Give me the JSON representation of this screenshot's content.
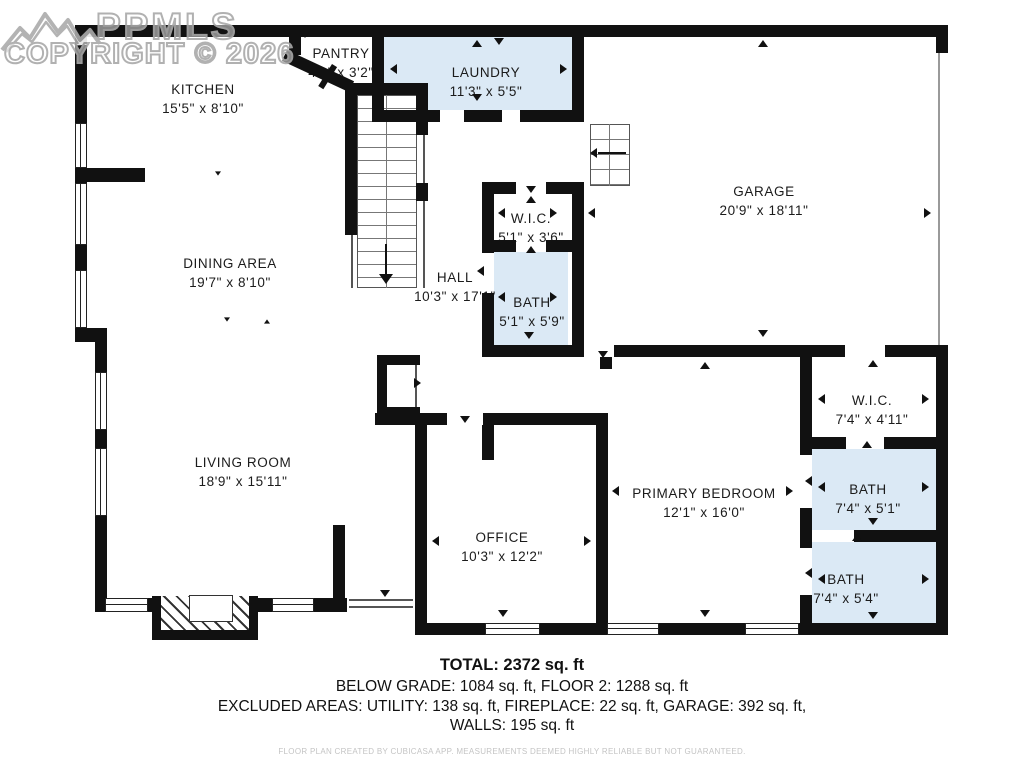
{
  "watermark": {
    "brand": "PPMLS",
    "copyright": "COPYRIGHT © 2026"
  },
  "rooms": {
    "kitchen": {
      "name": "KITCHEN",
      "dims": "15'5\" x 8'10\""
    },
    "pantry": {
      "name": "PANTRY",
      "dims": "4'8\" x 3'2\""
    },
    "laundry": {
      "name": "LAUNDRY",
      "dims": "11'3\" x 5'5\""
    },
    "garage": {
      "name": "GARAGE",
      "dims": "20'9\" x 18'11\""
    },
    "wic_main": {
      "name": "W.I.C.",
      "dims": "5'1\" x 3'6\""
    },
    "hall": {
      "name": "HALL",
      "dims": "10'3\" x 17'1\""
    },
    "bath_main": {
      "name": "BATH",
      "dims": "5'1\" x 5'9\""
    },
    "dining": {
      "name": "DINING AREA",
      "dims": "19'7\" x 8'10\""
    },
    "living": {
      "name": "LIVING ROOM",
      "dims": "18'9\" x 15'11\""
    },
    "office": {
      "name": "OFFICE",
      "dims": "10'3\" x 12'2\""
    },
    "primary": {
      "name": "PRIMARY BEDROOM",
      "dims": "12'1\" x 16'0\""
    },
    "wic_right": {
      "name": "W.I.C.",
      "dims": "7'4\" x 4'11\""
    },
    "bath_right1": {
      "name": "BATH",
      "dims": "7'4\" x 5'1\""
    },
    "bath_right2": {
      "name": "BATH",
      "dims": "7'4\" x 5'4\""
    }
  },
  "summary": {
    "total": "TOTAL: 2372 sq. ft",
    "line2": "BELOW GRADE: 1084 sq. ft, FLOOR 2: 1288 sq. ft",
    "line3": "EXCLUDED AREAS: UTILITY: 138 sq. ft, FIREPLACE: 22 sq. ft, GARAGE: 392 sq. ft,",
    "line4": "WALLS: 195 sq. ft",
    "disclaimer": "FLOOR PLAN CREATED BY CUBICASA APP. MEASUREMENTS DEEMED HIGHLY RELIABLE BUT NOT GUARANTEED."
  },
  "colors": {
    "wall": "#111111",
    "highlight_room": "#dbe9f5",
    "background": "#ffffff",
    "watermark": "#a9a9a9"
  }
}
